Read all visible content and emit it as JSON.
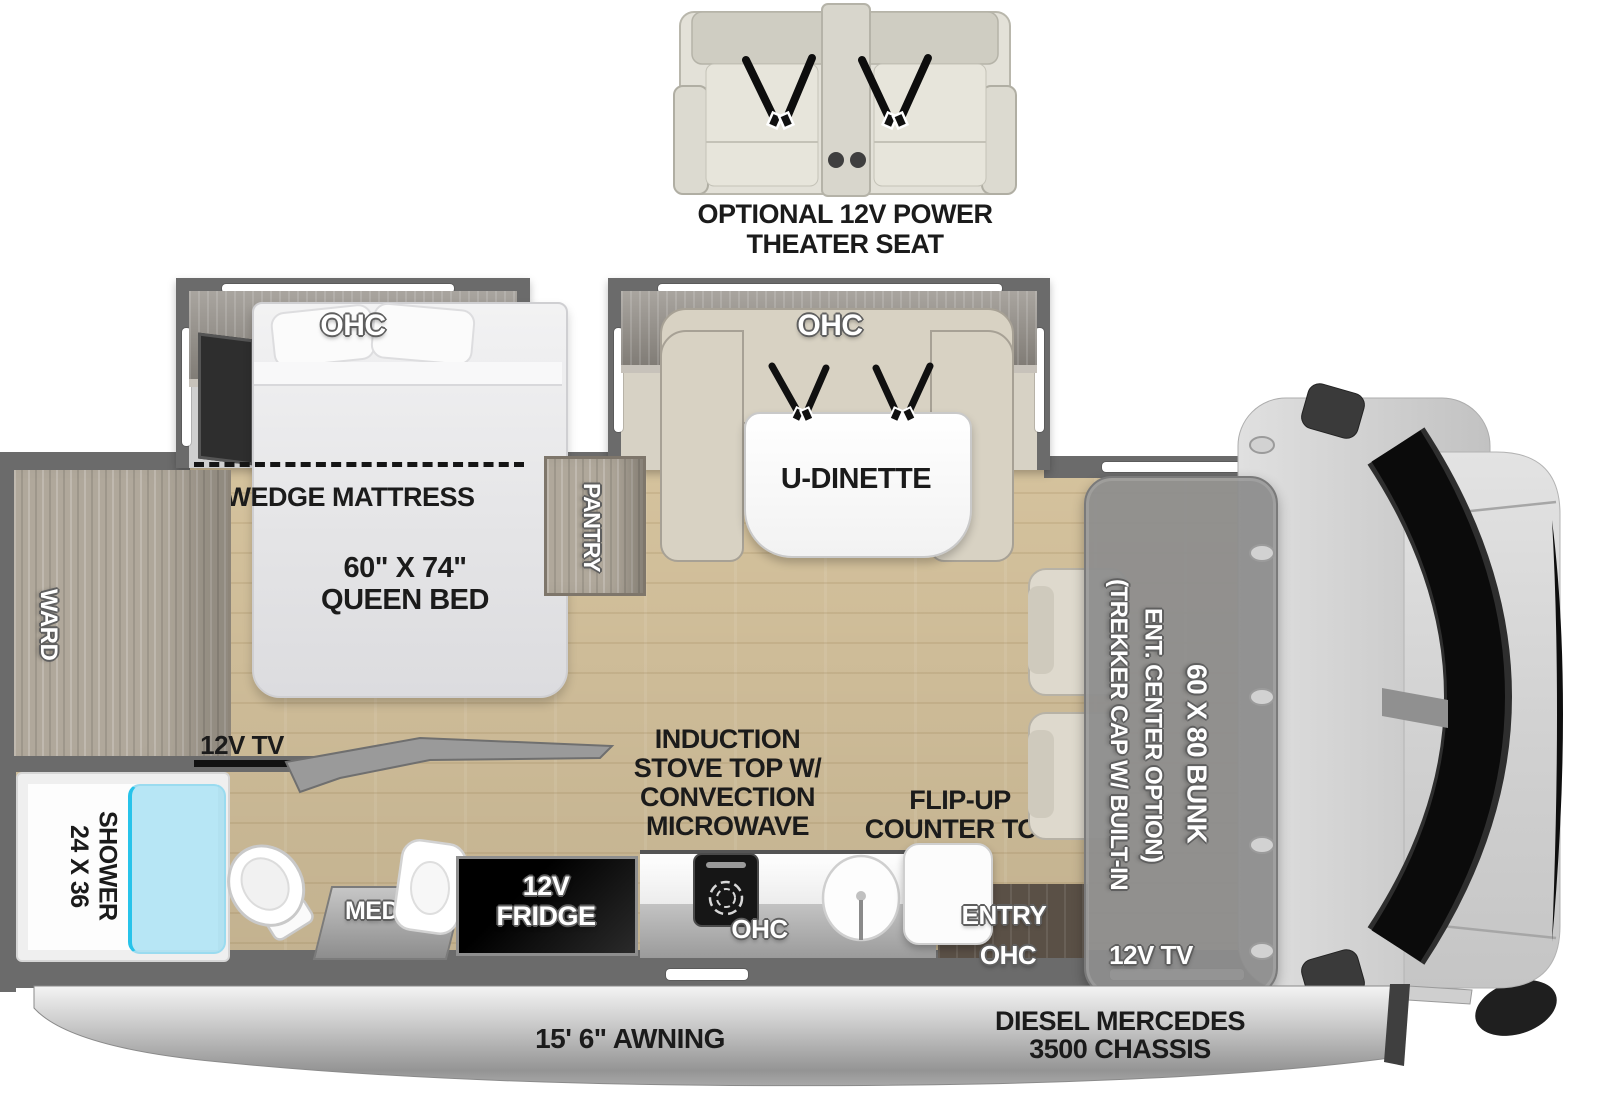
{
  "theater": {
    "line1": "OPTIONAL 12V POWER",
    "line2": "THEATER SEAT"
  },
  "bedroom": {
    "ohc": "OHC",
    "wedge_mattress": "WEDGE MATTRESS",
    "bed_size": "60\" X 74\"",
    "bed_name": "QUEEN BED",
    "tv": "12V TV",
    "ward": "WARD",
    "pantry": "PANTRY"
  },
  "bathroom": {
    "shower_size": "24 X 36",
    "shower": "SHOWER",
    "med": "MED"
  },
  "kitchen": {
    "fridge_line1": "12V",
    "fridge_line2": "FRIDGE",
    "appliance_line1": "INDUCTION",
    "appliance_line2": "STOVE TOP W/",
    "appliance_line3": "CONVECTION",
    "appliance_line4": "MICROWAVE",
    "flip_line1": "FLIP-UP",
    "flip_line2": "COUNTER TOP",
    "counter_ohc": "OHC",
    "entry": "ENTRY",
    "entry_ohc": "OHC"
  },
  "dinette": {
    "ohc": "OHC",
    "label": "U-DINETTE"
  },
  "bunk": {
    "trekker_line1": "(TREKKER CAP W/ BUILT-IN",
    "trekker_line2": "ENT. CENTER OPTION)",
    "size": "60 X 80 BUNK",
    "tv": "12V TV"
  },
  "exterior": {
    "awning": "15' 6\" AWNING",
    "chassis_line1": "DIESEL MERCEDES",
    "chassis_line2": "3500 CHASSIS"
  },
  "colors": {
    "wall": "#6b6b6b",
    "floor_wood": "#d9c6a0",
    "glass_accent": "#27c3ea",
    "bunk_gray": "#8d8d8d",
    "label_black": "#1b1b1b"
  }
}
